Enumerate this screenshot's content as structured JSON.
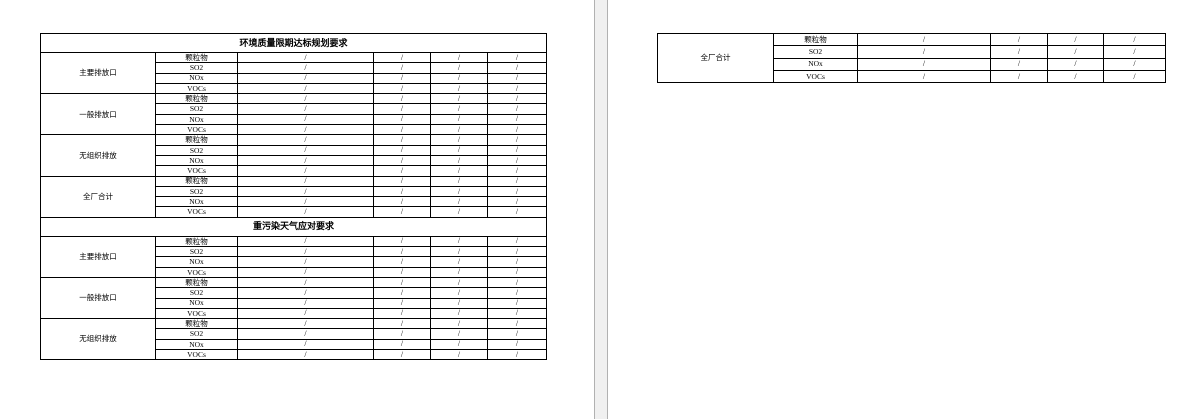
{
  "colors": {
    "page_background": "#ffffff",
    "gap_background": "#f0f0f0",
    "gap_edge": "#b1b1b1",
    "table_border": "#000000",
    "text": "#000000"
  },
  "pages": {
    "page1": {
      "table": {
        "name": "emissions-requirements-table",
        "sections": [
          {
            "title": "环境质量限期达标规划要求",
            "groups": [
              {
                "label": "主要排放口",
                "rows": [
                  [
                    "颗粒物",
                    "/",
                    "/",
                    "/",
                    "/"
                  ],
                  [
                    "SO2",
                    "/",
                    "/",
                    "/",
                    "/"
                  ],
                  [
                    "NOx",
                    "/",
                    "/",
                    "/",
                    "/"
                  ],
                  [
                    "VOCs",
                    "/",
                    "/",
                    "/",
                    "/"
                  ]
                ]
              },
              {
                "label": "一般排放口",
                "rows": [
                  [
                    "颗粒物",
                    "/",
                    "/",
                    "/",
                    "/"
                  ],
                  [
                    "SO2",
                    "/",
                    "/",
                    "/",
                    "/"
                  ],
                  [
                    "NOx",
                    "/",
                    "/",
                    "/",
                    "/"
                  ],
                  [
                    "VOCs",
                    "/",
                    "/",
                    "/",
                    "/"
                  ]
                ]
              },
              {
                "label": "无组织排放",
                "rows": [
                  [
                    "颗粒物",
                    "/",
                    "/",
                    "/",
                    "/"
                  ],
                  [
                    "SO2",
                    "/",
                    "/",
                    "/",
                    "/"
                  ],
                  [
                    "NOx",
                    "/",
                    "/",
                    "/",
                    "/"
                  ],
                  [
                    "VOCs",
                    "/",
                    "/",
                    "/",
                    "/"
                  ]
                ]
              },
              {
                "label": "全厂合计",
                "rows": [
                  [
                    "颗粒物",
                    "/",
                    "/",
                    "/",
                    "/"
                  ],
                  [
                    "SO2",
                    "/",
                    "/",
                    "/",
                    "/"
                  ],
                  [
                    "NOx",
                    "/",
                    "/",
                    "/",
                    "/"
                  ],
                  [
                    "VOCs",
                    "/",
                    "/",
                    "/",
                    "/"
                  ]
                ]
              }
            ]
          },
          {
            "title": "重污染天气应对要求",
            "groups": [
              {
                "label": "主要排放口",
                "rows": [
                  [
                    "颗粒物",
                    "/",
                    "/",
                    "/",
                    "/"
                  ],
                  [
                    "SO2",
                    "/",
                    "/",
                    "/",
                    "/"
                  ],
                  [
                    "NOx",
                    "/",
                    "/",
                    "/",
                    "/"
                  ],
                  [
                    "VOCs",
                    "/",
                    "/",
                    "/",
                    "/"
                  ]
                ]
              },
              {
                "label": "一般排放口",
                "rows": [
                  [
                    "颗粒物",
                    "/",
                    "/",
                    "/",
                    "/"
                  ],
                  [
                    "SO2",
                    "/",
                    "/",
                    "/",
                    "/"
                  ],
                  [
                    "NOx",
                    "/",
                    "/",
                    "/",
                    "/"
                  ],
                  [
                    "VOCs",
                    "/",
                    "/",
                    "/",
                    "/"
                  ]
                ]
              },
              {
                "label": "无组织排放",
                "rows": [
                  [
                    "颗粒物",
                    "/",
                    "/",
                    "/",
                    "/"
                  ],
                  [
                    "SO2",
                    "/",
                    "/",
                    "/",
                    "/"
                  ],
                  [
                    "NOx",
                    "/",
                    "/",
                    "/",
                    "/"
                  ],
                  [
                    "VOCs",
                    "/",
                    "/",
                    "/",
                    "/"
                  ]
                ]
              }
            ]
          }
        ]
      }
    },
    "page2": {
      "table": {
        "name": "emissions-requirements-table-continued",
        "sections": [
          {
            "title": "",
            "groups": [
              {
                "label": "全厂合计",
                "rows": [
                  [
                    "颗粒物",
                    "/",
                    "/",
                    "/",
                    "/"
                  ],
                  [
                    "SO2",
                    "/",
                    "/",
                    "/",
                    "/"
                  ],
                  [
                    "NOx",
                    "/",
                    "/",
                    "/",
                    "/"
                  ],
                  [
                    "VOCs",
                    "/",
                    "/",
                    "/",
                    "/"
                  ]
                ]
              }
            ]
          }
        ]
      }
    }
  }
}
